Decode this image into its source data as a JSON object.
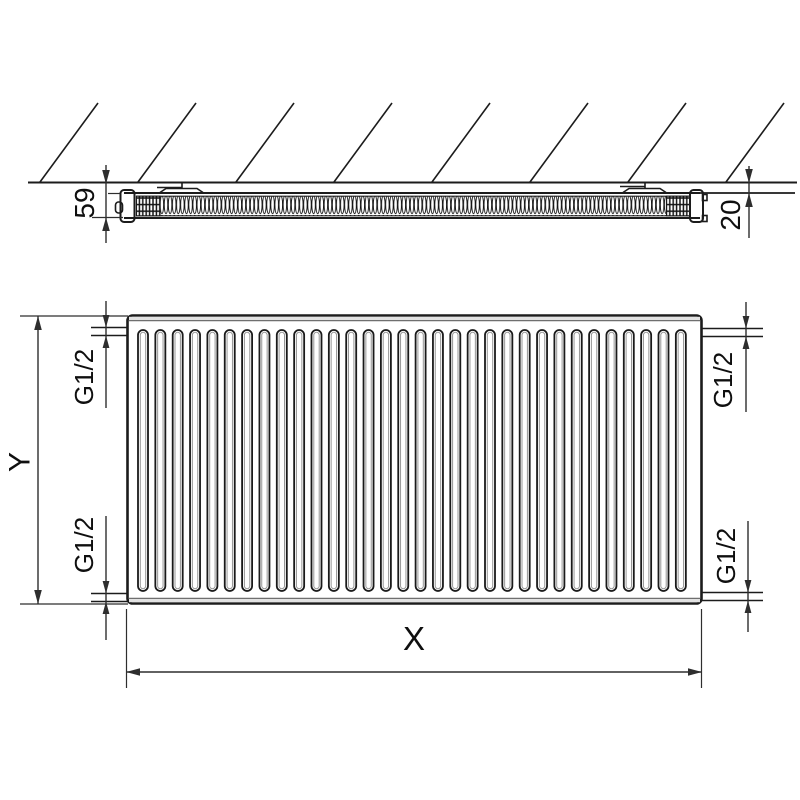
{
  "labels": {
    "depth": "59",
    "wall_distance": "20",
    "height": "Y",
    "length": "X",
    "thread_top_left": "G1/2",
    "thread_bottom_left": "G1/2",
    "thread_top_right": "G1/2",
    "thread_bottom_right": "G1/2"
  },
  "colors": {
    "line": "#1c1c1c",
    "dim": "#2e2e2e",
    "text": "#0f0f0f",
    "paper": "#ffffff"
  },
  "icons": {
    "hatch": "wall-hatching",
    "coil": "convector-fin-coil",
    "grid": "convector-end-grid"
  }
}
